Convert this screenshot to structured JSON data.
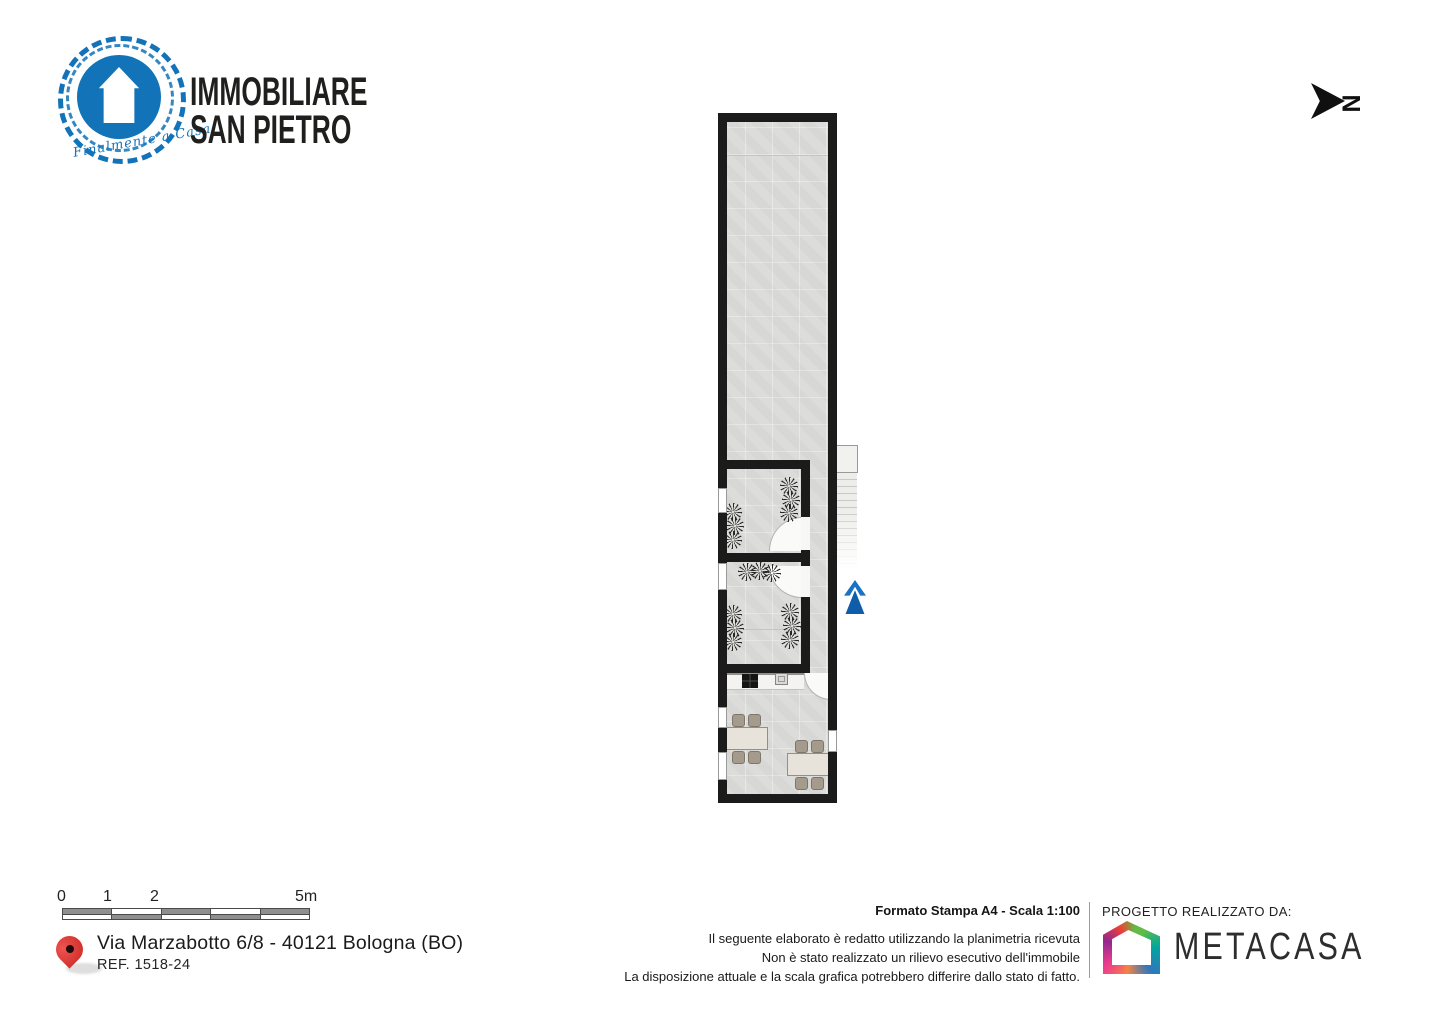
{
  "brand": {
    "line1": "IMMOBILIARE",
    "line2": "SAN PIETRO",
    "tagline": "Finalmente a Casa",
    "accent_blue": "#1273b8"
  },
  "compass": {
    "north_label": "N"
  },
  "scale_bar": {
    "labels": [
      "0",
      "1",
      "2",
      "5m"
    ]
  },
  "location": {
    "address": "Via Marzabotto 6/8 - 40121 Bologna (BO)",
    "reference": "REF. 1518-24",
    "pin_color": "#d43530"
  },
  "print": {
    "format": "Formato Stampa A4 - Scala 1:100",
    "disclaimer": [
      "Il seguente elaborato è redatto utilizzando la planimetria ricevuta",
      "Non è stato realizzato un rilievo esecutivo dell'immobile",
      "La disposizione attuale e la scala grafica potrebbero differire dallo stato di fatto."
    ]
  },
  "credit": {
    "label": "PROGETTO REALIZZATO DA:",
    "brand": "METACASA"
  },
  "floorplan": {
    "colors": {
      "wall": "#1b1b1b",
      "floor": "#dbdbd9",
      "entrance_arrow": "#1a72c2"
    }
  }
}
